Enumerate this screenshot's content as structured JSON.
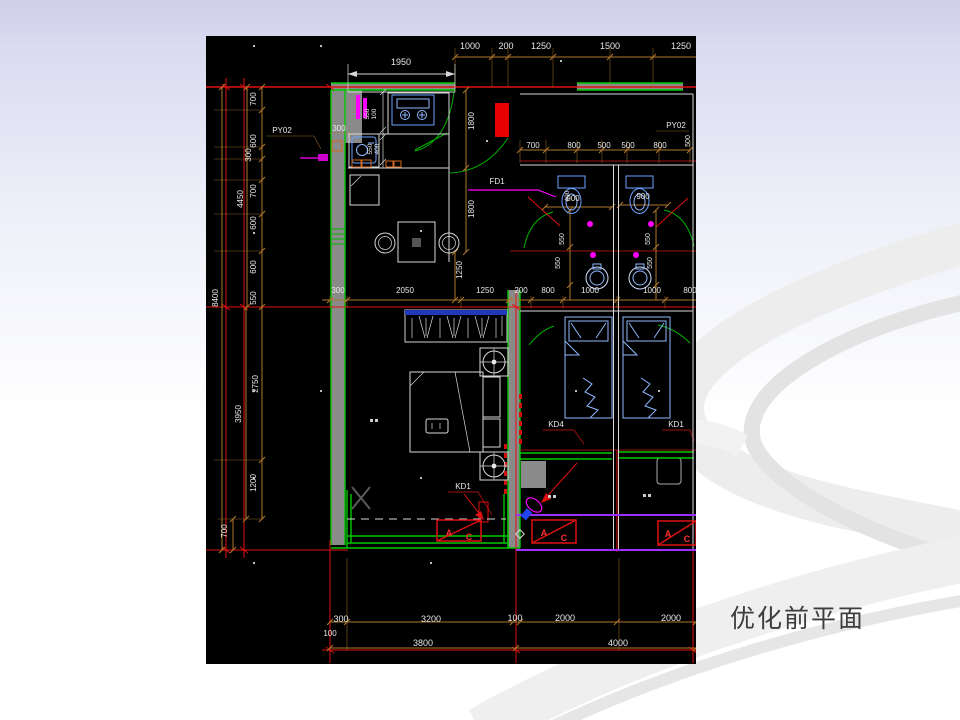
{
  "caption": "优化前平面",
  "colors": {
    "slide_top": "#cfcfea",
    "swoosh_gray": "#ededed",
    "cad_background": "#000000",
    "axis_red": "#e01010",
    "wall_green": "#00c800",
    "dim_tan": "#b0782c",
    "fixture_blue": "#6aa2ff",
    "accent_magenta": "#ff00ff",
    "balcony_purple": "#9b30ff",
    "wall_gray": "#8a8a8a",
    "caption_color": "#3d3d3d"
  },
  "plan": {
    "dims": {
      "top": [
        "1950",
        "1000",
        "200",
        "1250",
        "1500",
        "1250"
      ],
      "right_inner": [
        "700",
        "800",
        "500",
        "500",
        "800"
      ],
      "right_edge": "500",
      "left_col": [
        "700",
        "600",
        "300",
        "700",
        "600",
        "600",
        "550",
        "2750",
        "1200",
        "700"
      ],
      "left_groups": [
        "4450",
        "3950",
        "8400"
      ],
      "kitchen": [
        "550",
        "100",
        "550",
        "400"
      ],
      "vert_mid": [
        "1800",
        "1800",
        "1250"
      ],
      "bath": [
        "900",
        "900",
        "400",
        "550",
        "550",
        "550",
        "550"
      ],
      "mid_row": [
        "300",
        "2050",
        "1250",
        "200",
        "800",
        "1000",
        "1000",
        "800"
      ],
      "bottom_row1": [
        "300",
        "3200",
        "100",
        "2000",
        "2000",
        "100"
      ],
      "bottom_row2": [
        "3800",
        "4000"
      ],
      "wall": "300"
    },
    "tags": {
      "py02_left": "PY02",
      "py02_right": "PY02",
      "fd1": "FD1",
      "kd_master": "KD1",
      "kd_left": "KD4",
      "kd_right": "KD1",
      "ac_a": "A",
      "ac_c": "C"
    }
  }
}
